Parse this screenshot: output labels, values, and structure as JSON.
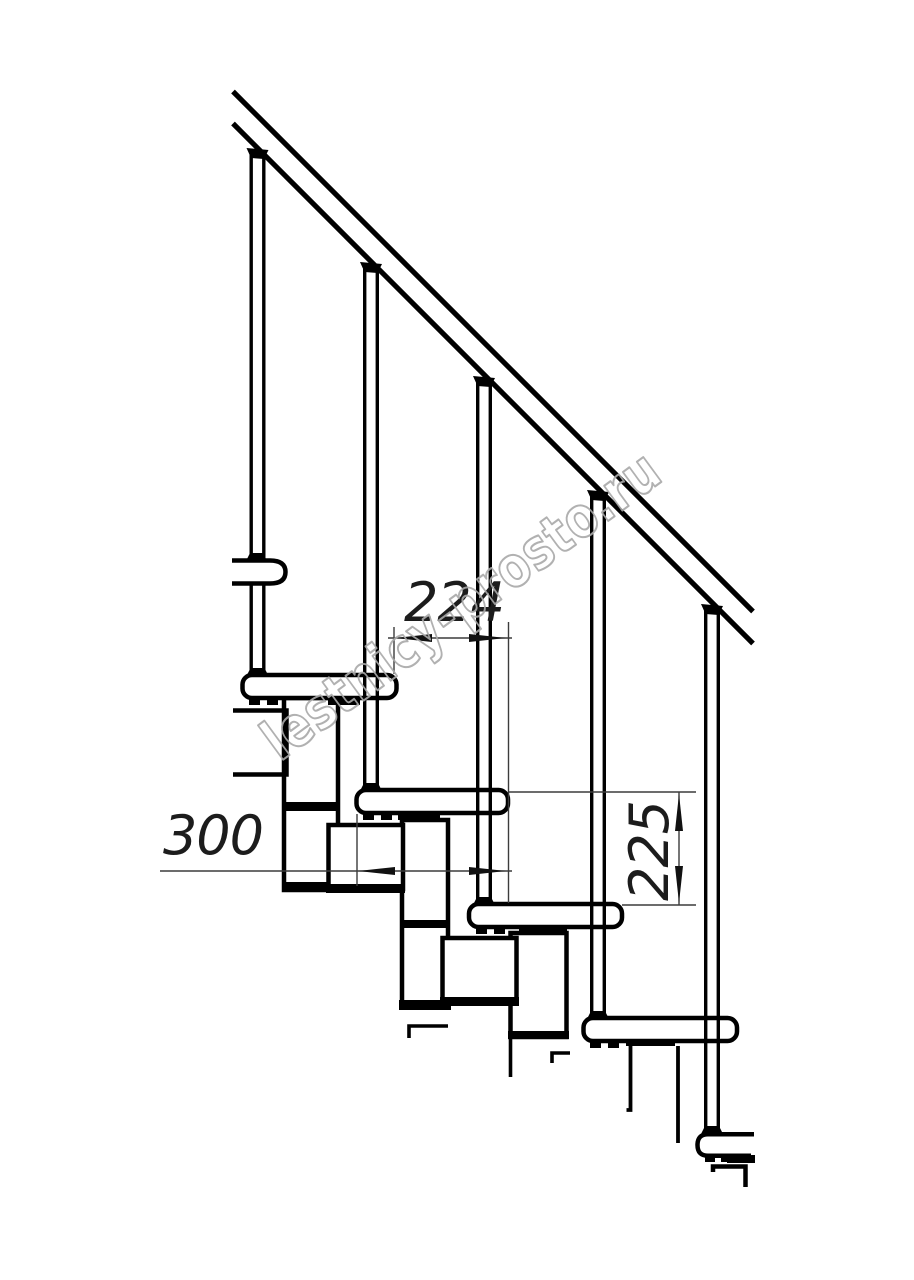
{
  "page": {
    "title": "Modular staircase side-view technical drawing",
    "background": "#ffffff"
  },
  "drawing": {
    "line_color": "#000000",
    "dimension_line_color": "#3c3c3c",
    "dimension_text_color": "#1c1c1c",
    "treads_count": 5,
    "balusters_count": 5,
    "handrail": "diagonal-45deg"
  },
  "dimensions": {
    "going": {
      "label": "224",
      "orientation": "horizontal"
    },
    "depth": {
      "label": "300",
      "orientation": "horizontal"
    },
    "rise": {
      "label": "225",
      "orientation": "vertical"
    }
  },
  "watermark": {
    "text": "lestnicy-prosto.ru",
    "color": "#a9a9a9"
  }
}
